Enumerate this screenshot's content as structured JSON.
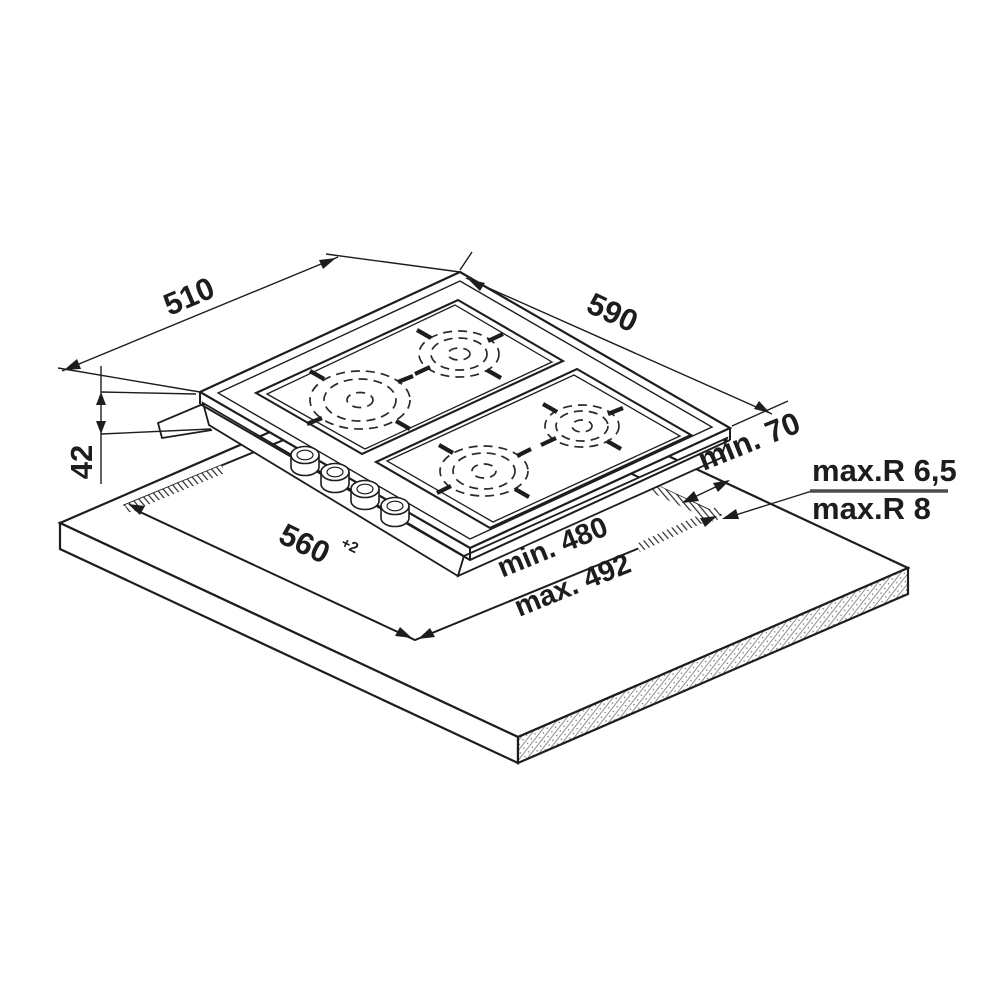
{
  "diagram": {
    "title": "gas-hob-installation-drawing",
    "labels": {
      "depth": "510",
      "width": "590",
      "height": "42",
      "cutout_width": "560",
      "cutout_width_tol": "+2",
      "rear_clearance": "min. 70",
      "cutout_depth_min": "min. 480",
      "cutout_depth_max": "max. 492",
      "corner_radius_top": "max.R 6,5",
      "corner_radius_bottom": "max.R 8"
    },
    "colors": {
      "line": "#1d1d1b",
      "text": "#1d1d1b",
      "divider": "#4c4c4c",
      "background": "#ffffff",
      "cutout_hatch": "#2b2b2b",
      "worktop_edge_speckle": "#909090"
    },
    "counts": {
      "burners": 4,
      "knobs": 4,
      "pan_supports": 2
    }
  }
}
